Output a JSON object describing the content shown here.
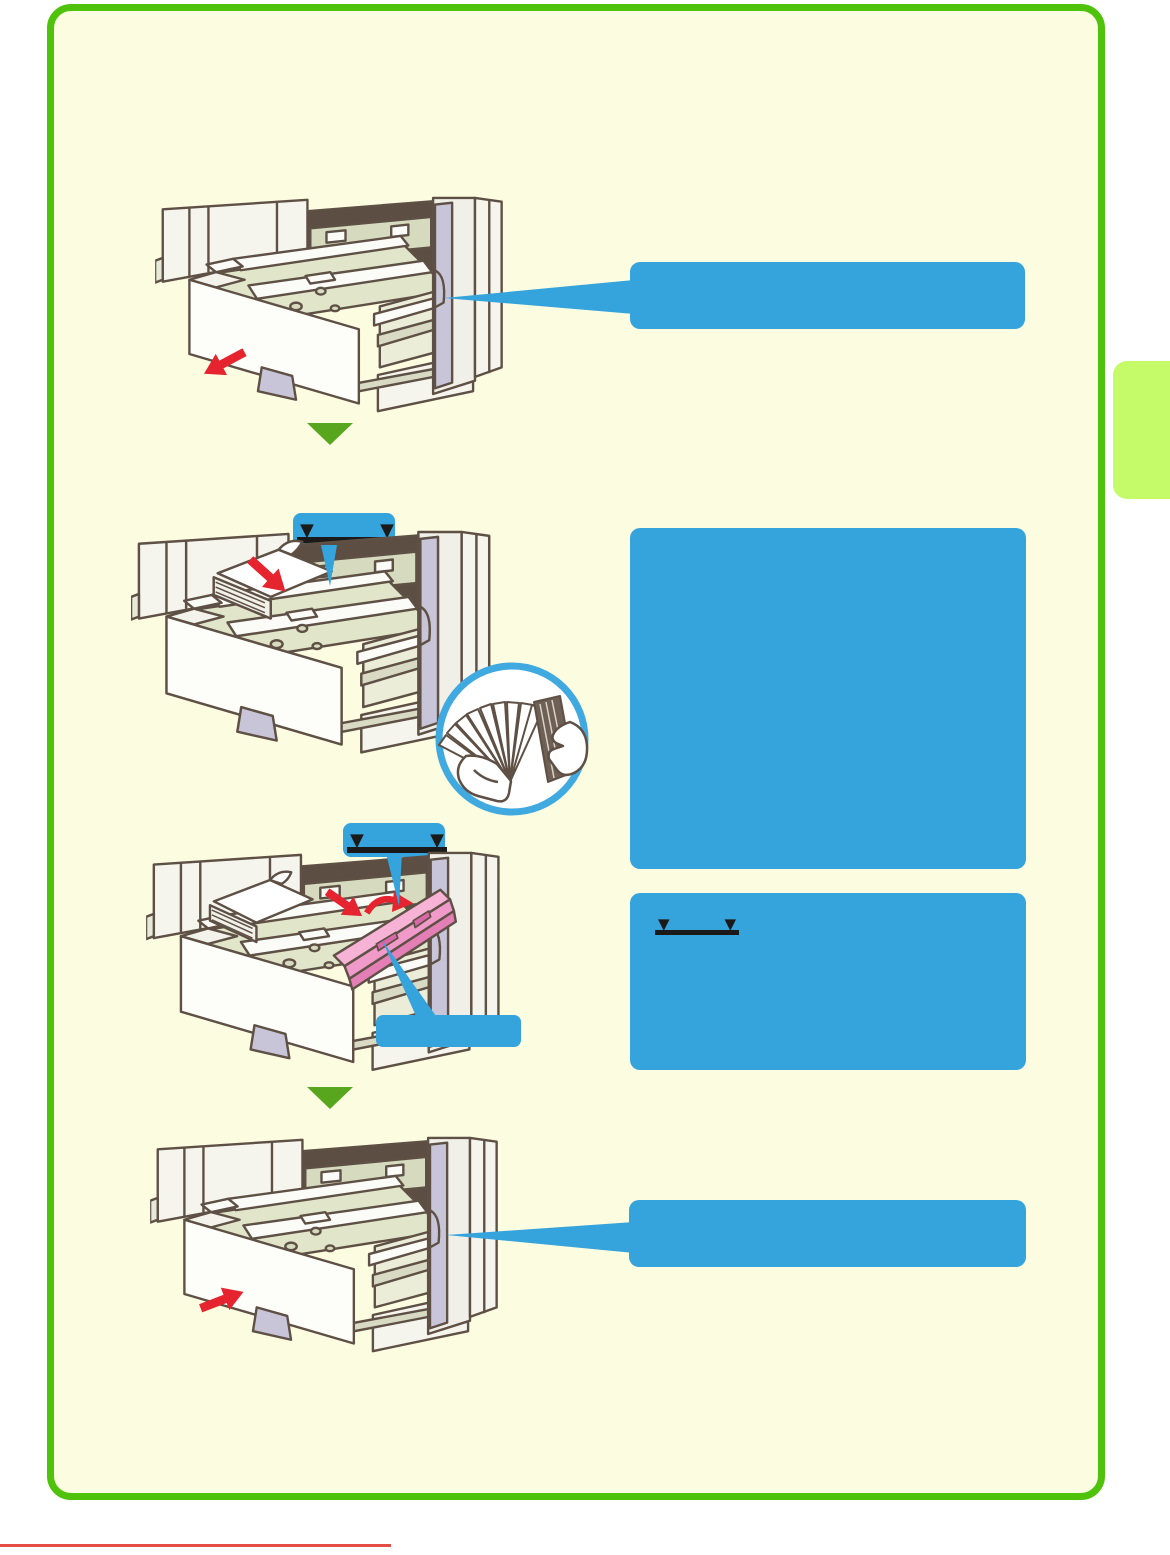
{
  "page": {
    "type": "printer-manual-paper-loading-page",
    "background": "#FFFFFF",
    "panel_background": "#FCFCE1",
    "border_color": "#4FC30B",
    "edge_tab_color": "#C5FA69",
    "bottom_rule_color": "#E34F44"
  },
  "palette": {
    "callout_blue": "#35A4DD",
    "arrow_red": "#E6242F",
    "step_arrow_green": "#58A51E",
    "guide_pink": "#F09ACA",
    "line_art_outline": "#5E5045",
    "indicator_black": "#1A1A1A"
  },
  "indicator": {
    "triangle": "▼"
  },
  "steps": [
    {
      "name": "pull-out-tray",
      "callout_text": ""
    },
    {
      "name": "fan-and-load-paper",
      "callout_text": "",
      "note_text": ""
    },
    {
      "name": "adjust-guide",
      "callout_text": ""
    },
    {
      "name": "push-tray-back",
      "callout_text": ""
    }
  ]
}
